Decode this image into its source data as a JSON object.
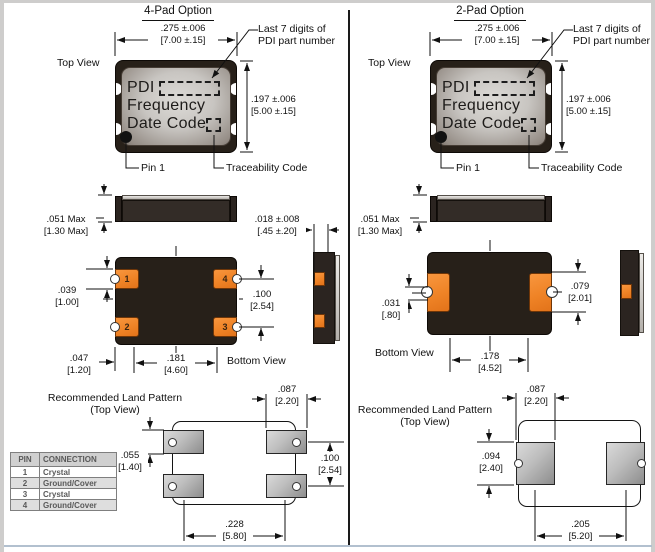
{
  "colors": {
    "package_body": "#272019",
    "pad_orange": "#ef8326",
    "land_pad_gray": "#bdbdbd",
    "rule_blue": "#b2c0cf",
    "line": "#111111"
  },
  "pin_table": {
    "headers": [
      "PIN",
      "CONNECTION"
    ],
    "rows": [
      [
        "1",
        "Crystal"
      ],
      [
        "2",
        "Ground/Cover"
      ],
      [
        "3",
        "Crystal"
      ],
      [
        "4",
        "Ground/Cover"
      ]
    ]
  },
  "left": {
    "title": "4-Pad Option",
    "top_view_label": "Top View",
    "bottom_view_label": "Bottom View",
    "pin1_label": "Pin 1",
    "traceability_label": "Traceability Code",
    "callout": {
      "line1": "Last 7 digits of",
      "line2": "PDI part number"
    },
    "chip": {
      "line1": "PDI",
      "line2": "Frequency",
      "line3": "Date Code"
    },
    "pad_numbers": {
      "p1": "1",
      "p2": "2",
      "p3": "3",
      "p4": "4"
    },
    "dims": {
      "width_in": ".275 ±.006",
      "width_mm": "[7.00 ±.15]",
      "height_in": ".197 ±.006",
      "height_mm": "[5.00 ±.15]",
      "thick_in": ".051 Max",
      "thick_mm": "[1.30 Max]",
      "standoff_in": ".018 ±.008",
      "standoff_mm": "[.45 ±.20]",
      "pad_h_in": ".039",
      "pad_h_mm": "[1.00]",
      "pitch_in": ".100",
      "pitch_mm": "[2.54]",
      "edge_in": ".047",
      "edge_mm": "[1.20]",
      "span_in": ".181",
      "span_mm": "[4.60]"
    },
    "land": {
      "title_line1": "Recommended Land Pattern",
      "title_line2": "(Top View)",
      "pad_w_in": ".087",
      "pad_w_mm": "[2.20]",
      "pad_h_in": ".055",
      "pad_h_mm": "[1.40]",
      "pitch_in": ".100",
      "pitch_mm": "[2.54]",
      "span_in": ".228",
      "span_mm": "[5.80]"
    }
  },
  "right": {
    "title": "2-Pad Option",
    "top_view_label": "Top View",
    "bottom_view_label": "Bottom View",
    "pin1_label": "Pin 1",
    "traceability_label": "Traceability Code",
    "callout": {
      "line1": "Last 7 digits of",
      "line2": "PDI part number"
    },
    "chip": {
      "line1": "PDI",
      "line2": "Frequency",
      "line3": "Date Code"
    },
    "dims": {
      "width_in": ".275 ±.006",
      "width_mm": "[7.00 ±.15]",
      "height_in": ".197 ±.006",
      "height_mm": "[5.00 ±.15]",
      "thick_in": ".051 Max",
      "thick_mm": "[1.30 Max]",
      "offset_in": ".031",
      "offset_mm": "[.80]",
      "pad_h_in": ".079",
      "pad_h_mm": "[2.01]",
      "span_in": ".178",
      "span_mm": "[4.52]"
    },
    "land": {
      "title_line1": "Recommended Land Pattern",
      "title_line2": "(Top View)",
      "pad_w_in": ".087",
      "pad_w_mm": "[2.20]",
      "pad_h_in": ".094",
      "pad_h_mm": "[2.40]",
      "span_in": ".205",
      "span_mm": "[5.20]"
    }
  }
}
